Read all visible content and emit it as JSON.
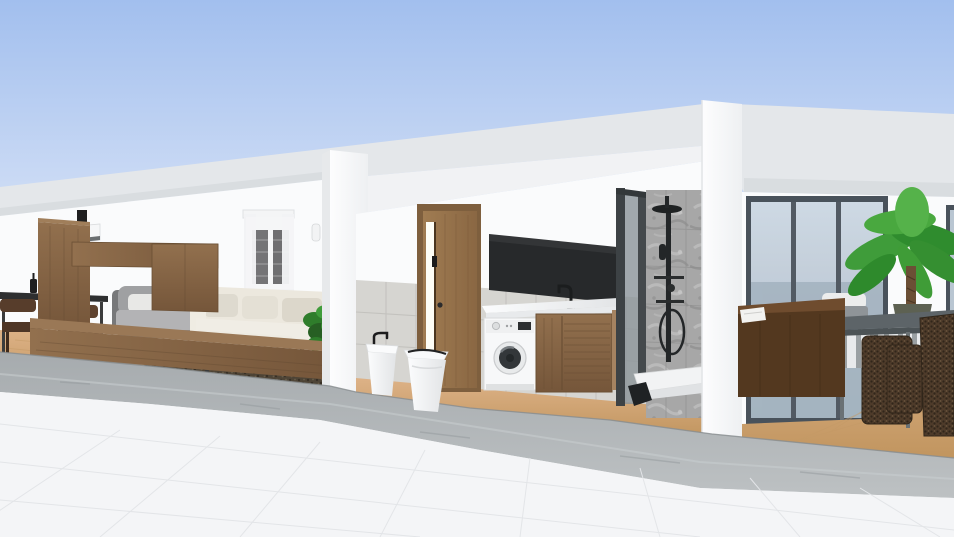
{
  "meta": {
    "scene_type": "3d-interior-dollhouse-render",
    "view": "front cutaway elevation of a flat-roof home"
  },
  "colors": {
    "sky_top": "#a2bfee",
    "sky_bottom": "#dbe5f7",
    "roof_slab": "#e4e7ea",
    "roof_fascia": "#d9dde0",
    "wall": "#fafbfc",
    "wall_ceiling": "#f1f2f4",
    "wall_shade": "#e7e9eb",
    "tile_wainscot": "#d6d5d1",
    "tile_grout": "#c2c1bd",
    "shower_tile": "#a7a7a7",
    "shower_frame": "#3d4245",
    "black_panel": "#27292b",
    "glass_top": "#ccd7e3",
    "glass_bottom": "#a9b7c3",
    "door_frame_gray": "#49525b",
    "wood_floor_light": "#ddb287",
    "wood_floor_dark": "#c1955f",
    "walnut_light": "#92704e",
    "walnut_dark": "#75563a",
    "door_wood_light": "#a07c52",
    "door_wood_dark": "#8a6743",
    "ceramic_light": "#fbfcfd",
    "ceramic_shade": "#e2e4e6",
    "sofa_cream": "#ece8de",
    "armchair_gray": "#9fa0a2",
    "rug": "#4e4436",
    "plant_green": "#3f9c3a",
    "wicker": "#4e3b2a",
    "table_glass": "#5d6468",
    "plinth_top": "#a6abae",
    "plinth_bottom": "#bdc1c3",
    "terrace": "#f4f5f7"
  },
  "scene": {
    "sky": {
      "label": "clear blue sky"
    },
    "roof": {
      "label": "flat roof slab"
    },
    "rooms": [
      {
        "id": "living-dining",
        "label": "living and dining room",
        "objects": [
          "wall ac unit",
          "dining table with bottles",
          "wooden dining chairs",
          "walnut wall unit",
          "speaker on cabinet",
          "gray armchair with pillow",
          "cream sectional sofa",
          "window with sheer curtains and dark shutters",
          "wall sconce",
          "dark area rug",
          "potted plant",
          "low walnut media bench"
        ]
      },
      {
        "id": "bathroom-laundry",
        "label": "bathroom and laundry",
        "objects": [
          "wooden door ajar",
          "black wall panel",
          "black basin faucet",
          "white countertop",
          "washing machine",
          "walnut vanity cabinet",
          "bidet",
          "toilet",
          "walk-in shower with glass door",
          "black shower column",
          "stone tile shower wall",
          "gray tile wainscot"
        ]
      },
      {
        "id": "patio-lounge",
        "label": "patio lounge",
        "objects": [
          "sliding glass doors",
          "side window",
          "gray chair with white cushion",
          "banana plant in pot",
          "dark wood sofa back with papers",
          "glass top patio table",
          "rattan chair",
          "rattan ottoman"
        ]
      }
    ],
    "foreground": {
      "plinth": "stone plinth step",
      "terrace": "white tile terrace floor"
    }
  }
}
